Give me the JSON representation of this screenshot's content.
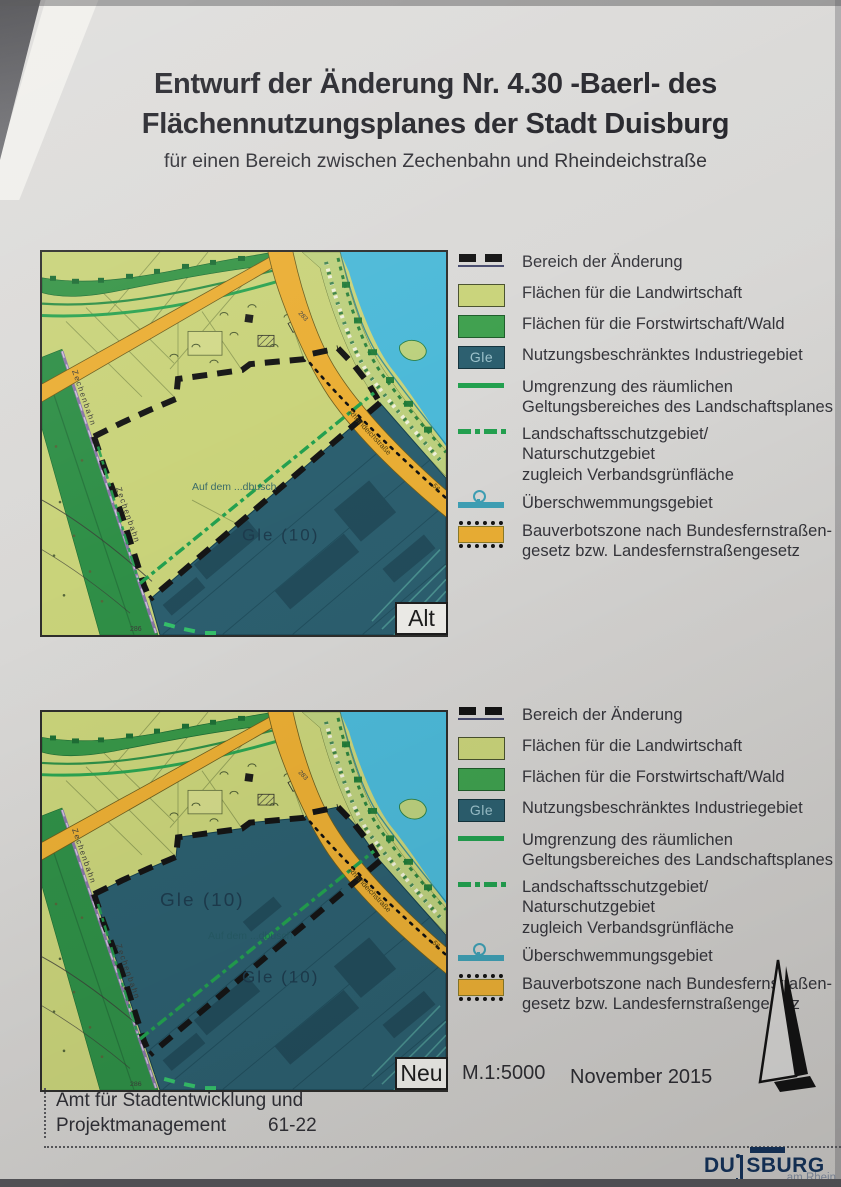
{
  "title": {
    "line1": "Entwurf der Änderung Nr. 4.30 -Baerl- des",
    "line2": "Flächennutzungsplanes der Stadt Duisburg",
    "subtitle": "für einen Bereich zwischen Zechenbahn und Rheindeichstraße"
  },
  "legend": {
    "gle_badge": "Gle",
    "items": [
      {
        "line1": "Bereich der Änderung",
        "line2": ""
      },
      {
        "line1": "Flächen für die Landwirtschaft",
        "line2": ""
      },
      {
        "line1": "Flächen für die Forstwirtschaft/Wald",
        "line2": ""
      },
      {
        "line1": "Nutzungsbeschränktes Industriegebiet",
        "line2": ""
      },
      {
        "line1": "Umgrenzung des räumlichen",
        "line2": "Geltungsbereiches des Landschaftsplanes"
      },
      {
        "line1": "Landschaftsschutzgebiet/ Naturschutzgebiet",
        "line2": "zugleich Verbandsgrünfläche"
      },
      {
        "line1": "Überschwemmungsgebiet",
        "line2": ""
      },
      {
        "line1": "Bauverbotszone nach Bundesfernstraßen-",
        "line2": "gesetz bzw. Landesfernstraßengesetz"
      }
    ]
  },
  "maps": {
    "alt_tag": "Alt",
    "neu_tag": "Neu"
  },
  "map_labels": {
    "gle": "Gle  (10)",
    "field_name": "Auf dem ...dbusch",
    "railway": "Zechenbahn",
    "street": "Rheindeichstraße",
    "street_no": "56",
    "road_no": "283",
    "elevation": "286"
  },
  "footer": {
    "scale": "M.1:5000",
    "date": "November 2015",
    "dept_line1": "Amt für Stadtentwicklung und",
    "dept_line2": "Projektmanagement",
    "dept_code": "61-22"
  },
  "logo": {
    "prefix": "DU",
    "suffix": "SBURG",
    "tagline": "am Rhein"
  },
  "colors": {
    "agriculture": "#c9d37a",
    "forest": "#3fa04e",
    "industry_teal": "#2c5f6f",
    "water": "#4cb9d8",
    "no_build_orange": "#eaae34",
    "boundary_black": "#151515",
    "landscape_green": "#23a04f",
    "flood_blue": "#3f9fb4",
    "logo_navy": "#15335a"
  }
}
